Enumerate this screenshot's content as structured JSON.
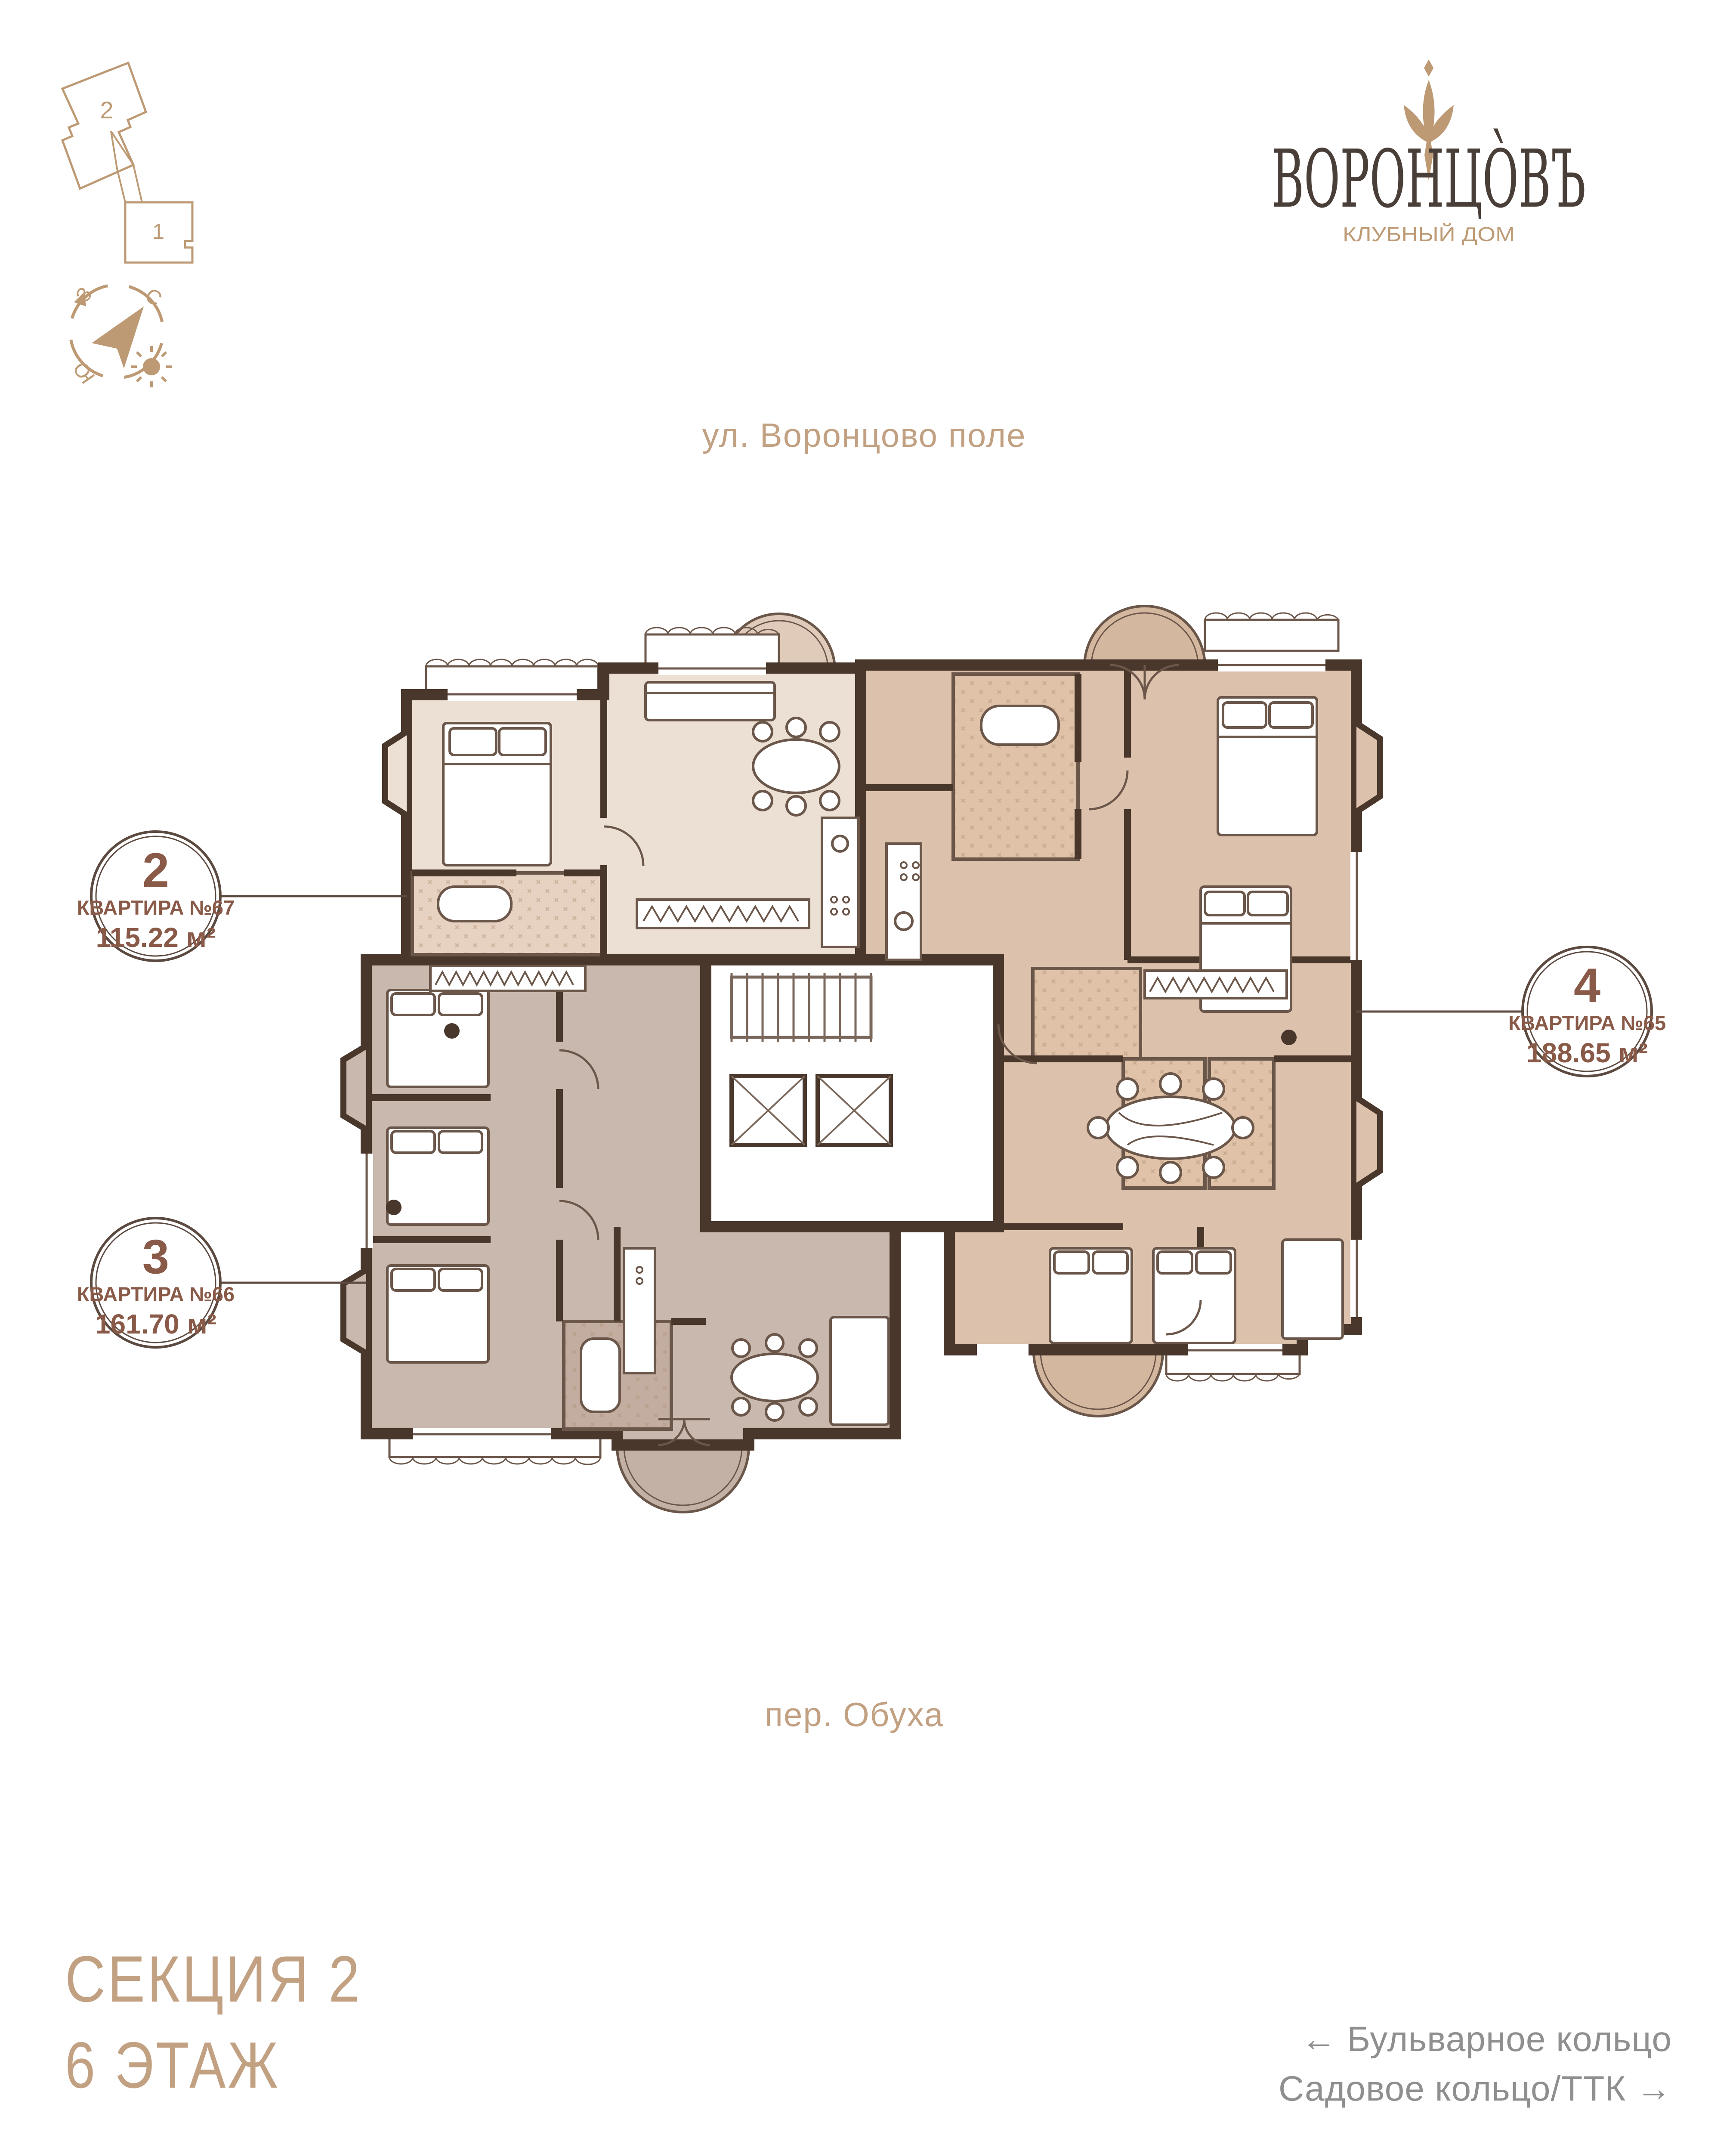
{
  "logo": {
    "ornament_icon": "fleur-ornament",
    "title": "ВОРОНЦО̀ВЪ",
    "subtitle": "КЛУБНЫЙ ДОМ",
    "title_color": "#4a3f38",
    "accent_color": "#bd9a74"
  },
  "mini_plan": {
    "section_2_label": "2",
    "section_1_label": "1"
  },
  "compass": {
    "west_label": "З",
    "north_label": "С",
    "south_label": "Ю"
  },
  "streets": {
    "top_label": "ул. Воронцово поле",
    "bottom_label": "пер. Обуха"
  },
  "apartments": [
    {
      "badge_number": "2",
      "title": "КВАРТИРА №67",
      "area": "115.22 м²",
      "fill_color": "#ece0d4"
    },
    {
      "badge_number": "3",
      "title": "КВАРТИРА №66",
      "area": "161.70 м²",
      "fill_color": "#c9b8ae"
    },
    {
      "badge_number": "4",
      "title": "КВАРТИРА №65",
      "area": "188.65 м²",
      "fill_color": "#dcc2ac"
    }
  ],
  "footer": {
    "section_label": "СЕКЦИЯ 2",
    "floor_label": "6 ЭТАЖ",
    "direction_left": "← Бульварное кольцо",
    "direction_right": "Садовое кольцо/ТТК →",
    "direction_color": "#8f8f8f"
  },
  "plan": {
    "wall_color": "#4a372c",
    "badge_text_color": "#8a5a48"
  }
}
